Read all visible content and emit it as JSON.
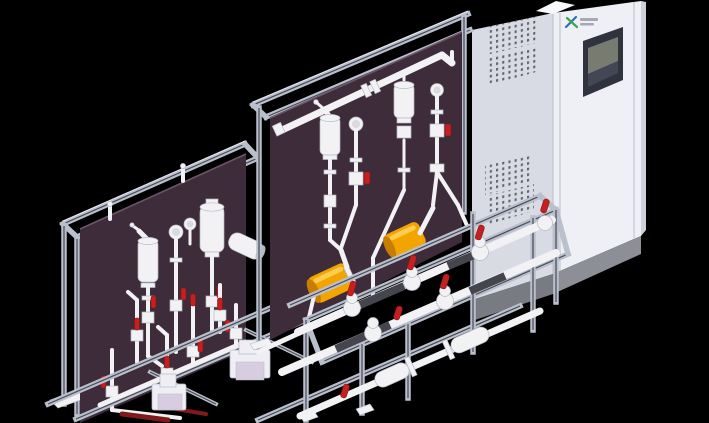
{
  "meta": {
    "kind": "3d-cad-render",
    "subject": "Two skid-mounted chemical dosing / metering units with an electrical control cabinet",
    "background": "black"
  },
  "colors": {
    "background": "#000000",
    "panel": "#3e2c3a",
    "panel_edge": "#6b5668",
    "frame": "#b9bfcb",
    "frame_dark": "#474a55",
    "frame_hi": "#e9ebf2",
    "pipe": "#f2f2f5",
    "pipe_shade": "#b6bac4",
    "pipe_dark": "#45464d",
    "pipe_red_dark": "#7e1a1a",
    "valve_red": "#c42020",
    "valve_red_dark": "#8c1414",
    "gauge_face": "#d8dade",
    "accent_yellow": "#f2a500",
    "accent_yellow_dark": "#c87d00",
    "accent_yellow_hi": "#ffd35e",
    "pump_body": "#efeef4",
    "pump_accent": "#d8cce0",
    "cabinet_front": "#eef0f5",
    "cabinet_side": "#d9dbe4",
    "cabinet_top": "#f7f8fb",
    "cabinet_strip": "#cfd1da",
    "cabinet_base": "#8d8f96",
    "cabinet_base_dark": "#797b82",
    "cabinet_line": "#c2c4cd",
    "vent_dot": "#62656f",
    "screen_bezel": "#30333e",
    "screen_glass": "#787c70",
    "screen_glass_dark": "#434654",
    "logo_blue": "#2f6fb8",
    "logo_green": "#36a852",
    "logo_text": "#a6a9b3"
  },
  "cabinet": {
    "label": "control-cabinet",
    "vent_groups": 4,
    "has_hmi_screen": true,
    "logo_mark": "ax-cross-mark"
  },
  "skids": [
    {
      "label": "rear-dosing-skid",
      "position": "left",
      "back_panel": "dark-plum",
      "visible_components": {
        "pulsation_dampeners": 2,
        "pressure_gauges": 2,
        "red_handle_valves": 8,
        "metering_pumps": 2,
        "angled_cylinder": 1
      }
    },
    {
      "label": "front-dosing-skid",
      "position": "center",
      "back_panel": "dark-plum",
      "visible_components": {
        "pulsation_dampeners": 2,
        "pressure_gauges": 2,
        "yellow_pump_heads": 2,
        "red_handle_valves": 8,
        "manifold_pipes": 3
      }
    }
  ]
}
